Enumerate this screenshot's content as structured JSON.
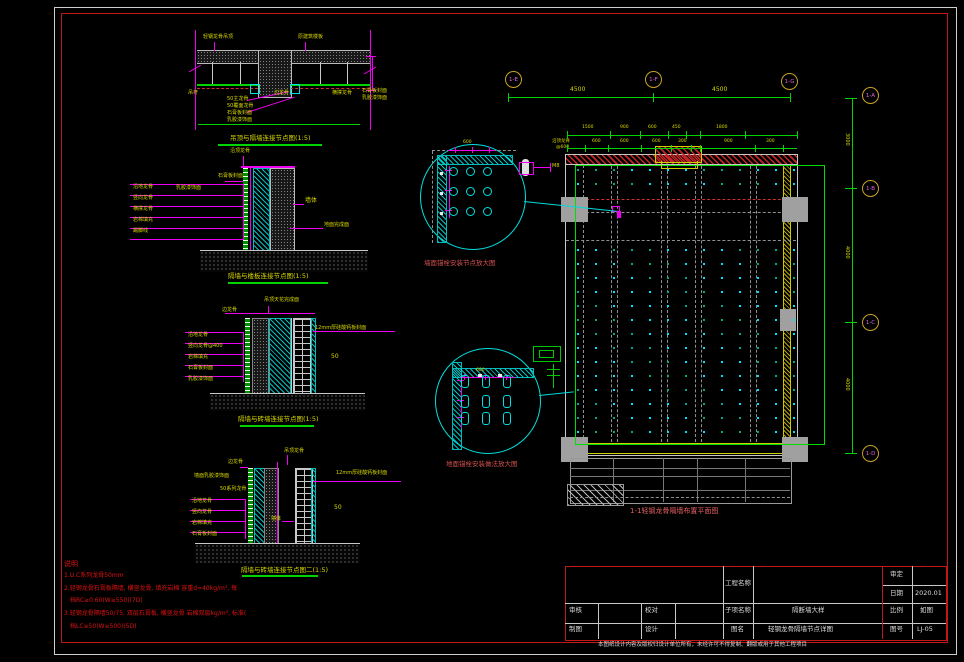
{
  "palette": {
    "Y": "#d8d800",
    "T": "#d8d800",
    "R": "#e01212",
    "RT": "#d65050",
    "PT": "#e86060",
    "W": "#dddddd",
    "M": "#e060e0"
  },
  "titleblock": {
    "project_label": "工程名称",
    "approve_label": "审定",
    "date_label": "日期",
    "date_value": "2020.01",
    "check_label": "审核",
    "proof_label": "校对",
    "draft_label": "制图",
    "design_label": "设计",
    "sub_label": "子项名称",
    "sub_value": "隔断墙大样",
    "scale_label": "比例",
    "scale_value": "如图",
    "sheet_label": "图名",
    "sheet_value": "轻钢龙骨隔墙节点详图",
    "no_label": "图号",
    "no_value": "LJ-05",
    "footer": "本图纸设计内容及版权归设计单位所有，未经许可不得复制、翻版或用于其他工程项目"
  },
  "axis_bubbles": [
    {
      "label": "1-E",
      "x": 505,
      "y": 71
    },
    {
      "label": "1-F",
      "x": 645,
      "y": 71
    },
    {
      "label": "1-G",
      "x": 781,
      "y": 73
    },
    {
      "label": "1-A",
      "x": 862,
      "y": 87
    },
    {
      "label": "1-B",
      "x": 862,
      "y": 180
    },
    {
      "label": "1-C",
      "x": 862,
      "y": 314
    },
    {
      "label": "1-D",
      "x": 862,
      "y": 445
    }
  ],
  "plan_dots": {
    "x0": 578,
    "dx": 18,
    "cols": 13,
    "rows": [
      170,
      184,
      250,
      264,
      278,
      292,
      306,
      320,
      334,
      348,
      362,
      376,
      390,
      404,
      418,
      432
    ],
    "c1": "#00e0ff",
    "c2": "#00a890"
  },
  "callout_a_dots": {
    "xs": [
      452,
      469,
      486
    ],
    "ys": [
      170,
      190,
      210
    ]
  },
  "callout_b_pills": {
    "xs": [
      464,
      485,
      506
    ],
    "ys": [
      380,
      400,
      417
    ]
  },
  "tick_groups": [
    {
      "dir": "v",
      "y": 93,
      "h": 9,
      "xs": [
        508,
        653,
        790
      ],
      "color": "#00d400"
    },
    {
      "dir": "h",
      "x": 845,
      "w": 12,
      "ys": [
        98,
        188,
        322,
        453
      ],
      "color": "#00d400"
    },
    {
      "dir": "v",
      "y": 131,
      "h": 8,
      "xs": [
        567,
        610,
        640,
        668,
        686,
        700,
        745,
        797
      ],
      "color": "#00d400"
    },
    {
      "dir": "v",
      "y": 145,
      "h": 7,
      "xs": [
        567,
        585,
        608,
        641,
        671,
        691,
        700,
        755,
        783
      ],
      "color": "#00d400"
    },
    {
      "dir": "v",
      "y": 147,
      "h": 6,
      "xs": [
        455,
        472,
        489
      ],
      "color": "#f000f0"
    },
    {
      "dir": "v",
      "y": 374,
      "h": 6,
      "xs": [
        464,
        485,
        506
      ],
      "color": "#f000f0"
    },
    {
      "dir": "h",
      "x": 445,
      "w": 7,
      "ys": [
        170,
        190,
        210
      ],
      "color": "#f000f0"
    },
    {
      "dir": "h",
      "x": 457,
      "w": 7,
      "ys": [
        380,
        400,
        417
      ],
      "color": "#f000f0"
    }
  ],
  "texts": [
    {
      "t": "轻钢龙骨吊顶",
      "x": 203,
      "y": 35,
      "c": "Y",
      "s": 5
    },
    {
      "t": "原建筑楼板",
      "x": 298,
      "y": 35,
      "c": "Y",
      "s": 5
    },
    {
      "t": "吊杆",
      "x": 188,
      "y": 91,
      "c": "Y",
      "s": 5
    },
    {
      "t": "边龙骨",
      "x": 274,
      "y": 91,
      "c": "Y",
      "s": 5
    },
    {
      "t": "横撑龙骨",
      "x": 332,
      "y": 91,
      "c": "Y",
      "s": 5
    },
    {
      "t": "石膏板封面",
      "x": 362,
      "y": 89,
      "c": "Y",
      "s": 5
    },
    {
      "t": "乳胶漆饰面",
      "x": 362,
      "y": 96,
      "c": "Y",
      "s": 5
    },
    {
      "t": "50主龙骨",
      "x": 227,
      "y": 97,
      "c": "Y",
      "s": 5
    },
    {
      "t": "50覆面龙骨",
      "x": 227,
      "y": 104,
      "c": "Y",
      "s": 5
    },
    {
      "t": "石膏板封面",
      "x": 227,
      "y": 111,
      "c": "Y",
      "s": 5
    },
    {
      "t": "乳胶漆饰面",
      "x": 227,
      "y": 118,
      "c": "Y",
      "s": 5
    },
    {
      "t": "吊顶与隔墙连接节点图(1:5)",
      "x": 230,
      "y": 135,
      "c": "T",
      "s": 6.5
    },
    {
      "t": "沿顶龙骨",
      "x": 230,
      "y": 149,
      "c": "Y",
      "s": 5
    },
    {
      "t": "石膏板封面",
      "x": 218,
      "y": 174,
      "c": "Y",
      "s": 5
    },
    {
      "t": "乳胶漆饰面",
      "x": 176,
      "y": 186,
      "c": "Y",
      "s": 5
    },
    {
      "t": "沿地龙骨",
      "x": 133,
      "y": 185,
      "c": "Y",
      "s": 5
    },
    {
      "t": "竖向龙骨",
      "x": 133,
      "y": 196,
      "c": "Y",
      "s": 5
    },
    {
      "t": "横撑龙骨",
      "x": 133,
      "y": 207,
      "c": "Y",
      "s": 5
    },
    {
      "t": "岩棉填充",
      "x": 133,
      "y": 218,
      "c": "Y",
      "s": 5
    },
    {
      "t": "踢脚线",
      "x": 133,
      "y": 229,
      "c": "Y",
      "s": 5
    },
    {
      "t": "墙体",
      "x": 305,
      "y": 198,
      "c": "Y",
      "s": 6
    },
    {
      "t": "地面完成面",
      "x": 324,
      "y": 223,
      "c": "Y",
      "s": 5
    },
    {
      "t": "隔墙与楼板连接节点图(1:5)",
      "x": 228,
      "y": 273,
      "c": "T",
      "s": 6.5
    },
    {
      "t": "吊顶天花完成面",
      "x": 264,
      "y": 298,
      "c": "Y",
      "s": 5
    },
    {
      "t": "边龙骨",
      "x": 222,
      "y": 308,
      "c": "Y",
      "s": 5
    },
    {
      "t": "沿地龙骨",
      "x": 188,
      "y": 333,
      "c": "Y",
      "s": 5
    },
    {
      "t": "竖向龙骨@400",
      "x": 188,
      "y": 344,
      "c": "Y",
      "s": 5
    },
    {
      "t": "岩棉填充",
      "x": 188,
      "y": 355,
      "c": "Y",
      "s": 5
    },
    {
      "t": "石膏板封面",
      "x": 188,
      "y": 366,
      "c": "Y",
      "s": 5
    },
    {
      "t": "乳胶漆饰面",
      "x": 188,
      "y": 377,
      "c": "Y",
      "s": 5
    },
    {
      "t": "12mm厚硅酸钙板封面",
      "x": 315,
      "y": 326,
      "c": "Y",
      "s": 5
    },
    {
      "t": "50",
      "x": 331,
      "y": 354,
      "c": "Y",
      "s": 6
    },
    {
      "t": "隔墙与砖墙连接节点图(1:5)",
      "x": 238,
      "y": 416,
      "c": "T",
      "s": 6.5
    },
    {
      "t": "吊顶龙骨",
      "x": 284,
      "y": 449,
      "c": "Y",
      "s": 5
    },
    {
      "t": "边龙骨",
      "x": 228,
      "y": 460,
      "c": "Y",
      "s": 5
    },
    {
      "t": "墙面乳胶漆饰面",
      "x": 194,
      "y": 474,
      "c": "Y",
      "s": 5
    },
    {
      "t": "50系列龙骨",
      "x": 220,
      "y": 487,
      "c": "Y",
      "s": 5
    },
    {
      "t": "沿地龙骨",
      "x": 192,
      "y": 499,
      "c": "Y",
      "s": 5
    },
    {
      "t": "竖向龙骨",
      "x": 192,
      "y": 510,
      "c": "Y",
      "s": 5
    },
    {
      "t": "岩棉填充",
      "x": 192,
      "y": 521,
      "c": "Y",
      "s": 5
    },
    {
      "t": "石膏板封面",
      "x": 192,
      "y": 532,
      "c": "Y",
      "s": 5
    },
    {
      "t": "12mm厚硅酸钙板封面",
      "x": 336,
      "y": 471,
      "c": "Y",
      "s": 5
    },
    {
      "t": "墙体",
      "x": 271,
      "y": 517,
      "c": "Y",
      "s": 5
    },
    {
      "t": "50",
      "x": 334,
      "y": 505,
      "c": "Y",
      "s": 6
    },
    {
      "t": "隔墙与砖墙连接节点图二(1:5)",
      "x": 241,
      "y": 567,
      "c": "T",
      "s": 6.5
    },
    {
      "t": "说明",
      "x": 64,
      "y": 561,
      "c": "R",
      "s": 7
    },
    {
      "t": "1.U.C系列龙骨50mm",
      "x": 64,
      "y": 573,
      "c": "R",
      "s": 6
    },
    {
      "t": "2.轻钢龙骨石膏板隔墙, 横竖龙骨, 填充岩棉 容重d=40kg/m³, 每",
      "x": 64,
      "y": 586,
      "c": "R",
      "s": 6
    },
    {
      "t": "档RC≥0.60(W≥550)(7D)",
      "x": 70,
      "y": 598,
      "c": "R",
      "s": 6
    },
    {
      "t": "3.轻钢龙骨隔墙50/75, 双层石膏板, 横竖龙骨 岩棉双层kg/m³, 标准(",
      "x": 64,
      "y": 611,
      "c": "R",
      "s": 6
    },
    {
      "t": "档LC≥50(W≥500)(5D)",
      "x": 70,
      "y": 624,
      "c": "R",
      "s": 6
    },
    {
      "t": "墙面锚栓安装节点放大图",
      "x": 424,
      "y": 260,
      "c": "RT",
      "s": 6.5
    },
    {
      "t": "地面锚栓安装做法放大图",
      "x": 446,
      "y": 461,
      "c": "RT",
      "s": 6.5
    },
    {
      "t": "M8",
      "x": 552,
      "y": 164,
      "c": "Y",
      "s": 5
    },
    {
      "t": "600",
      "x": 463,
      "y": 141,
      "c": "Y",
      "s": 4.5
    },
    {
      "t": "600",
      "x": 476,
      "y": 369,
      "c": "Y",
      "s": 4.5
    },
    {
      "t": "沿顶龙骨",
      "x": 552,
      "y": 140,
      "c": "Y",
      "s": 4.5
    },
    {
      "t": "@600",
      "x": 556,
      "y": 146,
      "c": "Y",
      "s": 4.5
    },
    {
      "t": "1-1轻钢龙骨隔墙布置平面图",
      "x": 630,
      "y": 508,
      "c": "PT",
      "s": 7
    },
    {
      "t": "4500",
      "x": 570,
      "y": 87,
      "c": "Y",
      "s": 6
    },
    {
      "t": "4500",
      "x": 712,
      "y": 87,
      "c": "Y",
      "s": 6
    },
    {
      "t": "3000",
      "x": 849,
      "y": 133,
      "c": "Y",
      "s": 5,
      "r": 90
    },
    {
      "t": "4000",
      "x": 849,
      "y": 246,
      "c": "Y",
      "s": 5,
      "r": 90
    },
    {
      "t": "4000",
      "x": 849,
      "y": 378,
      "c": "Y",
      "s": 5,
      "r": 90
    },
    {
      "t": "1500",
      "x": 582,
      "y": 126,
      "c": "Y",
      "s": 4.5
    },
    {
      "t": "900",
      "x": 620,
      "y": 126,
      "c": "Y",
      "s": 4.5
    },
    {
      "t": "600",
      "x": 648,
      "y": 126,
      "c": "Y",
      "s": 4.5
    },
    {
      "t": "450",
      "x": 672,
      "y": 126,
      "c": "Y",
      "s": 4.5
    },
    {
      "t": "1800",
      "x": 716,
      "y": 126,
      "c": "Y",
      "s": 4.5
    },
    {
      "t": "600",
      "x": 592,
      "y": 140,
      "c": "Y",
      "s": 4.5
    },
    {
      "t": "600",
      "x": 620,
      "y": 140,
      "c": "Y",
      "s": 4.5
    },
    {
      "t": "600",
      "x": 652,
      "y": 140,
      "c": "Y",
      "s": 4.5
    },
    {
      "t": "300",
      "x": 678,
      "y": 140,
      "c": "Y",
      "s": 4.5
    },
    {
      "t": "900",
      "x": 724,
      "y": 140,
      "c": "Y",
      "s": 4.5
    },
    {
      "t": "300",
      "x": 766,
      "y": 140,
      "c": "Y",
      "s": 4.5
    }
  ]
}
